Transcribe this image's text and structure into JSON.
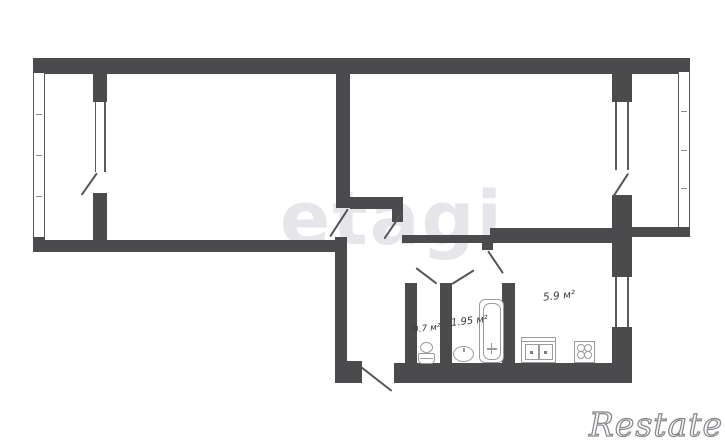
{
  "title": "apartment-floor-plan",
  "labels": {
    "wc_area": "0.7 м²",
    "bathroom_area": "1.95 м²",
    "kitchen_area": "5.9 м²"
  },
  "watermarks": {
    "center": "etagi",
    "corner": "Restate"
  },
  "colors": {
    "wall": "#4b4b4d",
    "background": "#ffffff",
    "fixture_outline": "#9b9b9f",
    "label_text": "#3b3b3d",
    "watermark_center": "#e6e6ea",
    "watermark_corner_outline": "#85858a"
  },
  "rooms": [
    "room-left",
    "room-right",
    "hall",
    "wc",
    "bathroom",
    "kitchen",
    "balcony-left",
    "balcony-right"
  ],
  "fixtures": [
    "toilet",
    "wash-basin",
    "bathtub",
    "kitchen-sink",
    "stove"
  ]
}
